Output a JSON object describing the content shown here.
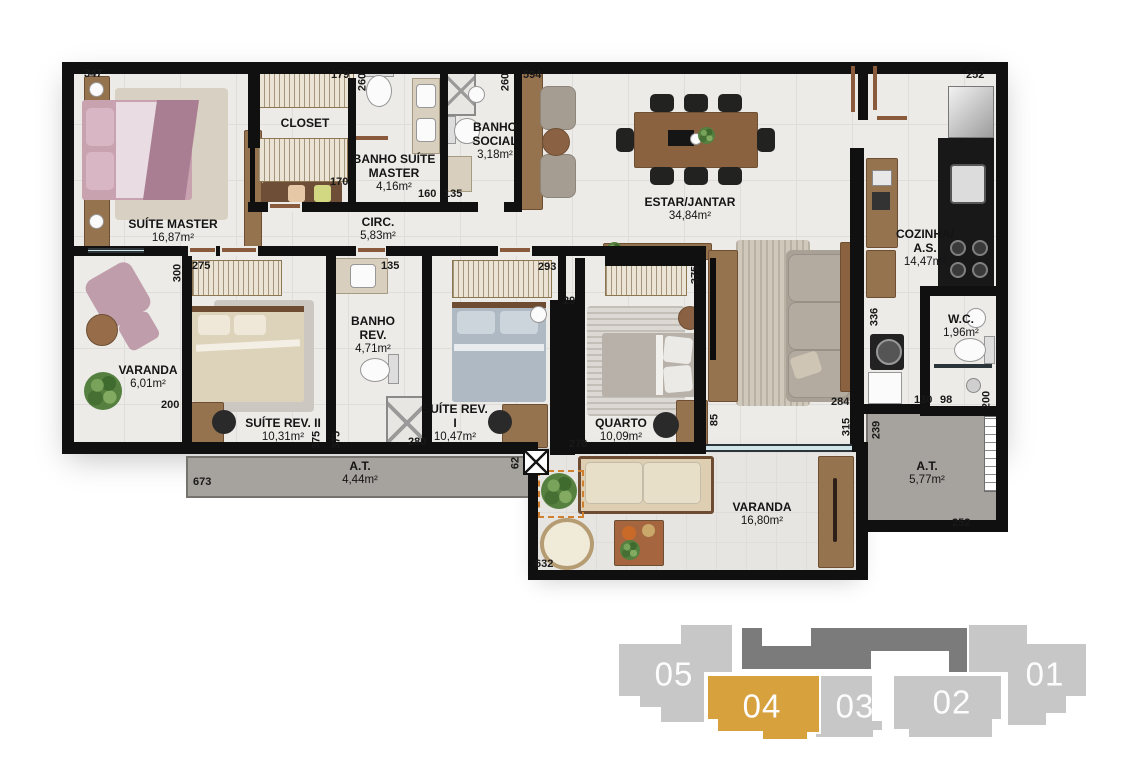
{
  "colors": {
    "wall": "#101010",
    "floor": "#ecebe8",
    "technical_area": "#a6a29d",
    "wood": "#96734f",
    "highlight_gold": "#d7a23e",
    "keyplan_gray": "#c7c7c7",
    "keyplan_core_gray": "#7b7b7b"
  },
  "rooms": {
    "suite_master": {
      "name": "SUÍTE MASTER",
      "area": "16,87m²"
    },
    "closet": {
      "name": "CLOSET",
      "area": ""
    },
    "banho_suite_master": {
      "name": "BANHO SUÍTE MASTER",
      "area": "4,16m²"
    },
    "circ": {
      "name": "CIRC.",
      "area": "5,83m²"
    },
    "banho_social": {
      "name": "BANHO SOCIAL",
      "area": "3,18m²"
    },
    "estar_jantar": {
      "name": "ESTAR/JANTAR",
      "area": "34,84m²"
    },
    "cozinha_as": {
      "name": "COZINHA/ A.S.",
      "area": "14,47m²"
    },
    "varanda_suite": {
      "name": "VARANDA",
      "area": "6,01m²"
    },
    "suite_rev_2": {
      "name": "SUÍTE REV. II",
      "area": "10,31m²"
    },
    "banho_rev": {
      "name": "BANHO REV.",
      "area": "4,71m²"
    },
    "suite_rev_1": {
      "name": "SUÍTE REV. I",
      "area": "10,47m²"
    },
    "quarto": {
      "name": "QUARTO",
      "area": "10,09m²"
    },
    "wc": {
      "name": "W.C.",
      "area": "1,96m²"
    },
    "at_1": {
      "name": "A.T.",
      "area": "4,44m²"
    },
    "varanda_social": {
      "name": "VARANDA",
      "area": "16,80m²"
    },
    "at_2": {
      "name": "A.T.",
      "area": "5,77m²"
    }
  },
  "dims": {
    "t347": "347",
    "t179": "179",
    "t594": "594",
    "t252_top": "252",
    "t260_a": "260",
    "t260_b": "260",
    "t170": "170",
    "t160": "160",
    "t135_a": "135",
    "t275": "275",
    "t135_b": "135",
    "t293": "293",
    "t29": "29",
    "t300": "300",
    "t200_left": "200",
    "t280": "280",
    "t270": "270",
    "t375_a": "375",
    "t375_b": "375",
    "t375_c": "375",
    "t62": "62",
    "t85": "85",
    "t284": "284",
    "t315": "315",
    "t336": "336",
    "t130": "130",
    "t98": "98",
    "t200_right": "200",
    "t239": "239",
    "t673": "673",
    "t632": "632",
    "t252_bottom": "252"
  },
  "keyplan": {
    "units": [
      {
        "label": "05"
      },
      {
        "label": "04"
      },
      {
        "label": "03"
      },
      {
        "label": "02"
      },
      {
        "label": "01"
      }
    ],
    "highlighted_unit": "04",
    "colors": {
      "unit": "#c7c7c7",
      "highlight": "#d7a23e",
      "core": "#7b7b7b",
      "label": "#ffffff"
    }
  }
}
